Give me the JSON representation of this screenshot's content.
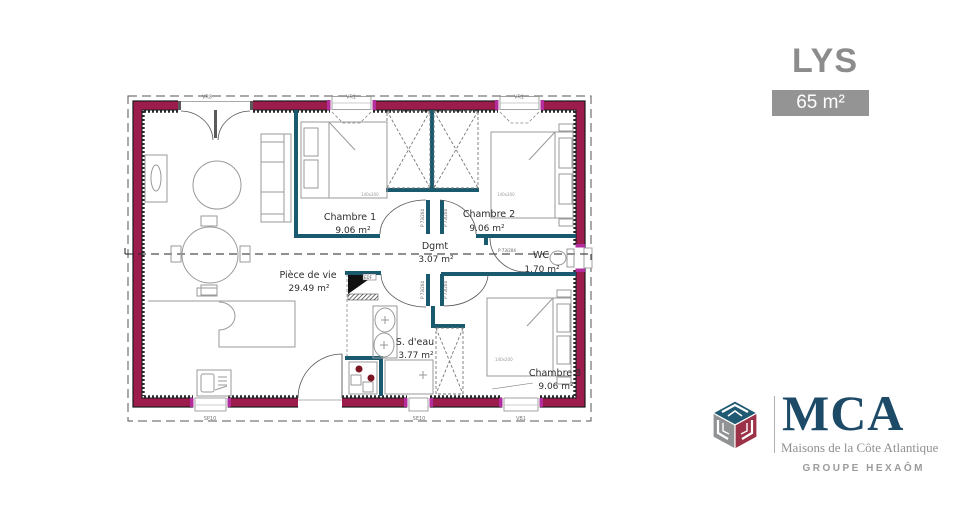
{
  "title": {
    "model": "LYS",
    "area": "65 m²"
  },
  "plan": {
    "rooms": {
      "chambre1": {
        "name": "Chambre 1",
        "area": "9.06 m²"
      },
      "chambre2": {
        "name": "Chambre 2",
        "area": "9.06 m²"
      },
      "chambre3": {
        "name": "Chambre 3",
        "area": "9.06 m²"
      },
      "dgmt": {
        "name": "Dgmt",
        "area": "3.07 m²"
      },
      "wc": {
        "name": "WC",
        "area": "1.70 m²"
      },
      "piece_de_vie": {
        "name": "Pièce de vie",
        "area": "29.49 m²"
      },
      "sdeau": {
        "name": "S. d'eau",
        "area": "3.77 m²"
      }
    },
    "openings": {
      "top_left": "VR8",
      "top_mid": "VR1",
      "top_right": "VR1",
      "bottom_left": "SP10",
      "bottom_mid": "SE10",
      "bottom_right": "VB1",
      "right_side": "SP10"
    },
    "door_label": "P 73/204",
    "bed_label": "140x200",
    "edf": "EDF"
  },
  "logo": {
    "brand": "MCA",
    "tagline": "Maisons de la Côte Atlantique",
    "group": "GROUPE HEXAÔM"
  },
  "colors": {
    "exterior_wall": "#9b1c4d",
    "window_jamb": "#b32d9e",
    "interior_wall": "#1a5a6f",
    "brand_blue": "#1d4b67",
    "brand_red": "#9c3247",
    "brand_gray": "#909294",
    "title_gray": "#8c8c8c"
  }
}
